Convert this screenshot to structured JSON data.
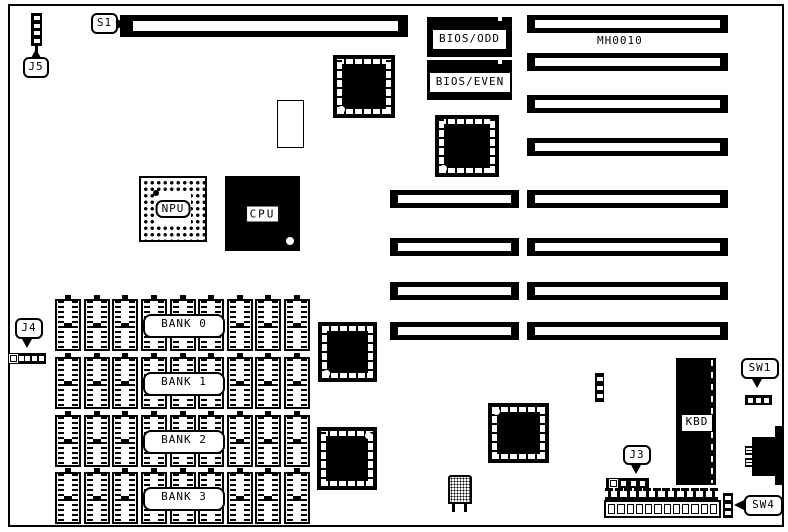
{
  "board": {
    "model": "MH0010",
    "callouts": {
      "j5": "J5",
      "s1": "S1",
      "j4": "J4",
      "j3": "J3",
      "sw1": "SW1",
      "sw4": "SW4"
    },
    "chips": {
      "npu": "NPU",
      "cpu": "CPU",
      "kbd": "KBD",
      "bios_odd": "BIOS/ODD",
      "bios_even": "BIOS/EVEN"
    },
    "banks": [
      {
        "label": "BANK 0"
      },
      {
        "label": "BANK 1"
      },
      {
        "label": "BANK 2"
      },
      {
        "label": "BANK 3"
      }
    ]
  }
}
